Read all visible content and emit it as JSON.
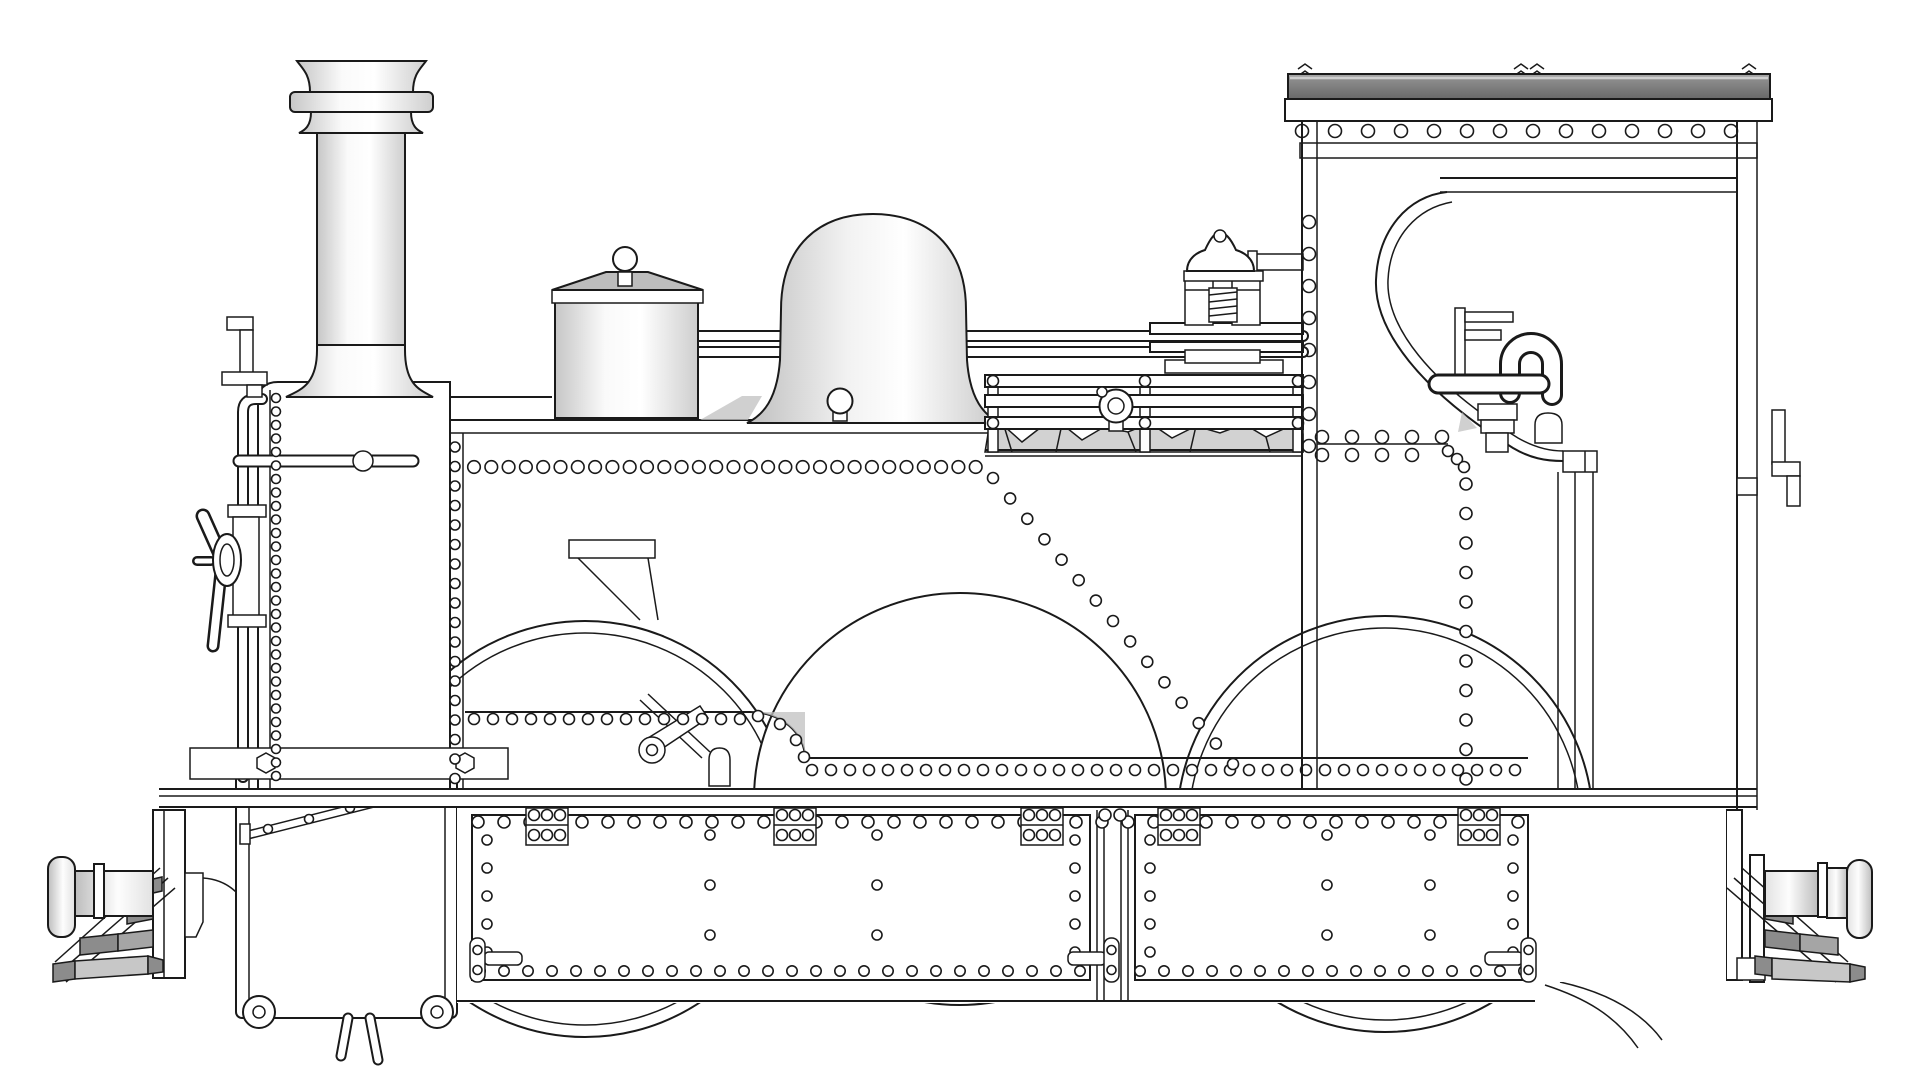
{
  "title": "Steam locomotive side elevation technical drawing",
  "drawing": {
    "type": "monochrome CAD-style line drawing",
    "subject": "0-6-0 side tank steam locomotive, side elevation",
    "background": "#ffffff",
    "text_content": "none (drawing contains no visible text)"
  },
  "colors": {
    "line": "#1a1a1a",
    "background": "#ffffff",
    "roof_dark": "#6e6e6e",
    "roof_light": "#a9a9a9",
    "step_dark": "#8c8c8c",
    "step_mid": "#a5a5a5",
    "step_light": "#c7c7c7",
    "coal": "#d2d2d2",
    "shade": "#c0c0c0",
    "lid_grey": "#bdbdbd"
  },
  "components": [
    "chimney",
    "smokebox",
    "smokebox-door-handwheel",
    "smokebox-handrail",
    "lamp-bracket-front",
    "boiler-handrail",
    "top-feed-cylinder",
    "steam-dome",
    "whistle",
    "coal-rack",
    "coal-load",
    "safety-valve",
    "globe-valve",
    "side-tank",
    "tank-step",
    "cab",
    "cab-roof",
    "cab-opening",
    "cab-pipework",
    "rear-lamp-bracket",
    "footplate",
    "frame-panels",
    "axlebox-bolt-plates",
    "frame-latches",
    "cylinder-block",
    "valve-rod",
    "front-buffer",
    "rear-buffer",
    "front-steps",
    "rear-steps",
    "drag-box",
    "wheels",
    "brake-hoses"
  ],
  "figure": {
    "rivet_rows": [
      [
        474,
        986,
        467,
        17.3,
        6.3
      ],
      [
        1322,
        1444,
        437,
        30,
        6.5
      ],
      [
        1322,
        1440,
        455,
        30,
        6.5
      ],
      [
        474,
        750,
        719,
        19,
        5.5
      ],
      [
        812,
        1524,
        770,
        19,
        5.5
      ],
      [
        478,
        1526,
        822,
        26,
        6
      ],
      [
        480,
        1086,
        971,
        24,
        5.2
      ],
      [
        1140,
        1524,
        971,
        24,
        5.2
      ],
      [
        1302,
        1762,
        131,
        33,
        6.5
      ]
    ],
    "rivet_cols": [
      [
        276,
        398,
        776,
        13.5,
        4.5
      ],
      [
        455,
        447,
        779,
        19.5,
        5
      ],
      [
        1309,
        222,
        446,
        32,
        6.5
      ],
      [
        1466,
        484,
        779,
        29.5,
        6
      ],
      [
        487,
        840,
        952,
        28,
        5
      ],
      [
        1075,
        840,
        952,
        28,
        5
      ],
      [
        1150,
        840,
        952,
        28,
        5
      ],
      [
        1513,
        840,
        952,
        28,
        5
      ]
    ],
    "rivet_diag": [
      993,
      478,
      1233,
      764,
      14,
      5.5
    ],
    "rivet_pts": [
      [
        710,
        835,
        5
      ],
      [
        710,
        885,
        5
      ],
      [
        710,
        935,
        5
      ],
      [
        877,
        835,
        5
      ],
      [
        877,
        885,
        5
      ],
      [
        877,
        935,
        5
      ],
      [
        1327,
        835,
        5
      ],
      [
        1327,
        885,
        5
      ],
      [
        1327,
        935,
        5
      ],
      [
        1430,
        835,
        5
      ],
      [
        1430,
        885,
        5
      ],
      [
        1430,
        935,
        5
      ],
      [
        758,
        716,
        5.5
      ],
      [
        780,
        724,
        5.5
      ],
      [
        796,
        740,
        5.5
      ],
      [
        804,
        757,
        5.5
      ],
      [
        1448,
        451,
        5.5
      ],
      [
        1457,
        459,
        5.5
      ],
      [
        1464,
        467,
        5.5
      ],
      [
        1105,
        815,
        6
      ],
      [
        1120,
        815,
        6
      ]
    ],
    "bolt_plates": {
      "cx": [
        547,
        795,
        1042,
        1179,
        1479
      ],
      "y": 808,
      "w": 42,
      "h": 37,
      "bolt_r": 5.5
    },
    "latches": [
      {
        "x": 470,
        "pin_x": 484,
        "pin_w": 38
      },
      {
        "x": 1104,
        "pin_x": 1068,
        "pin_w": 38
      },
      {
        "x": 1521,
        "pin_x": 1485,
        "pin_w": 38
      }
    ],
    "roof_spikes": [
      1305,
      1521,
      1537,
      1749
    ],
    "steps_front": {
      "polys": [
        {
          "p": [
            [
              140,
              882
            ],
            [
              162,
              877
            ],
            [
              162,
              891
            ],
            [
              140,
              896
            ]
          ],
          "c": "step_dark"
        },
        {
          "p": [
            [
              127,
              908
            ],
            [
              153,
              903
            ],
            [
              153,
              919
            ],
            [
              127,
              924
            ]
          ],
          "c": "step_dark"
        },
        {
          "p": [
            [
              80,
              938
            ],
            [
              118,
              934
            ],
            [
              118,
              951
            ],
            [
              80,
              955
            ]
          ],
          "c": "step_dark"
        },
        {
          "p": [
            [
              118,
              934
            ],
            [
              153,
              930
            ],
            [
              153,
              947
            ],
            [
              118,
              951
            ]
          ],
          "c": "step_mid"
        },
        {
          "p": [
            [
              53,
              964
            ],
            [
              75,
              961
            ],
            [
              75,
              979
            ],
            [
              53,
              982
            ]
          ],
          "c": "step_dark"
        },
        {
          "p": [
            [
              75,
              961
            ],
            [
              148,
              956
            ],
            [
              148,
              974
            ],
            [
              75,
              979
            ]
          ],
          "c": "step_light"
        },
        {
          "p": [
            [
              148,
              956
            ],
            [
              163,
              960
            ],
            [
              163,
              972
            ],
            [
              148,
              974
            ]
          ],
          "c": "step_dark"
        }
      ],
      "stringers": [
        [
          160,
          868,
          55,
          962
        ],
        [
          168,
          878,
          60,
          972
        ],
        [
          175,
          888,
          66,
          982
        ]
      ]
    },
    "steps_rear": {
      "polys": [
        {
          "p": [
            [
              1765,
              877
            ],
            [
              1778,
              882
            ],
            [
              1778,
              896
            ],
            [
              1765,
              891
            ]
          ],
          "c": "step_dark"
        },
        {
          "p": [
            [
              1765,
              903
            ],
            [
              1793,
              908
            ],
            [
              1793,
              924
            ],
            [
              1765,
              919
            ]
          ],
          "c": "step_dark"
        },
        {
          "p": [
            [
              1765,
              930
            ],
            [
              1800,
              934
            ],
            [
              1800,
              951
            ],
            [
              1765,
              947
            ]
          ],
          "c": "step_dark"
        },
        {
          "p": [
            [
              1800,
              934
            ],
            [
              1838,
              938
            ],
            [
              1838,
              955
            ],
            [
              1800,
              951
            ]
          ],
          "c": "step_mid"
        },
        {
          "p": [
            [
              1755,
              956
            ],
            [
              1772,
              958
            ],
            [
              1772,
              976
            ],
            [
              1755,
              974
            ]
          ],
          "c": "step_dark"
        },
        {
          "p": [
            [
              1772,
              958
            ],
            [
              1850,
              964
            ],
            [
              1850,
              982
            ],
            [
              1772,
              979
            ]
          ],
          "c": "step_light"
        },
        {
          "p": [
            [
              1850,
              964
            ],
            [
              1865,
              967
            ],
            [
              1865,
              979
            ],
            [
              1850,
              982
            ]
          ],
          "c": "step_dark"
        }
      ],
      "stringers": [
        [
          1742,
          868,
          1848,
          962
        ],
        [
          1734,
          878,
          1842,
          972
        ],
        [
          1727,
          888,
          1836,
          982
        ]
      ]
    },
    "coal_path": "M985,452 L988,434 L1004,426 L1022,442 L1040,428 L1062,424 L1082,440 L1104,427 L1128,432 L1150,423 L1172,438 L1196,426 L1220,433 L1244,424 L1266,437 L1288,427 L1303,434 L1303,452 Z",
    "coal_facets": [
      [
        1004,
        426,
        1012,
        452
      ],
      [
        1062,
        424,
        1056,
        452
      ],
      [
        1128,
        432,
        1136,
        452
      ],
      [
        1196,
        426,
        1190,
        452
      ],
      [
        1266,
        437,
        1270,
        452
      ]
    ]
  }
}
